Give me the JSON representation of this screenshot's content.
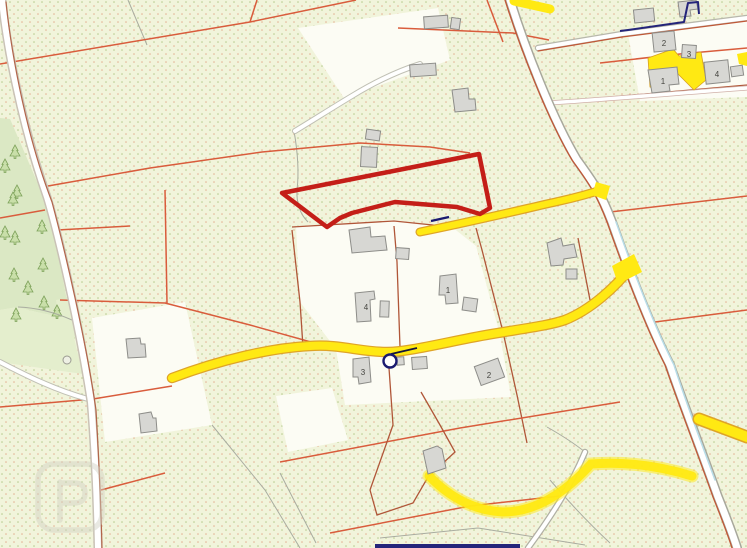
{
  "map": {
    "type": "cadastral-parcel-map",
    "palette": {
      "field": "#f1f4db",
      "dot_green": "#b6cb8e",
      "dot_salmon": "#e09e80",
      "forest": "#dbe8c4",
      "grass": "#e4eecd",
      "parcel_white": "#fcfcf4",
      "boundary": "#d95c3c",
      "boundary_dark": "#b05638",
      "road_fill": "#ffffff",
      "road_casing": "#a8a89c",
      "minor_road": "#ffe913",
      "minor_road_edge": "#dfa427",
      "highlight": "#c41e18",
      "navy": "#24247a"
    },
    "highlight_parcel": {
      "color": "#c41e18",
      "points": "282,193 479,154 490,208 480,214 457,207 395,202 352,213 340,218 327,227"
    },
    "marker": {
      "cx": "390",
      "cy": "361",
      "r": "6.5",
      "color": "#1a1a70"
    },
    "marker_leader": {
      "x1": "391",
      "y1": "354",
      "x2": "417",
      "y2": "348"
    },
    "annotation_dash": {
      "x1": "431",
      "y1": "221",
      "x2": "449",
      "y2": "217"
    },
    "plots": {
      "center": [
        "1",
        "2",
        "3",
        "4"
      ],
      "northeast": [
        "1",
        "2",
        "3",
        "4"
      ]
    },
    "bottom_bar": {
      "x": "375",
      "y": "544",
      "width": "145",
      "height": "4"
    },
    "watermark_icon": "property-portal-logo"
  }
}
